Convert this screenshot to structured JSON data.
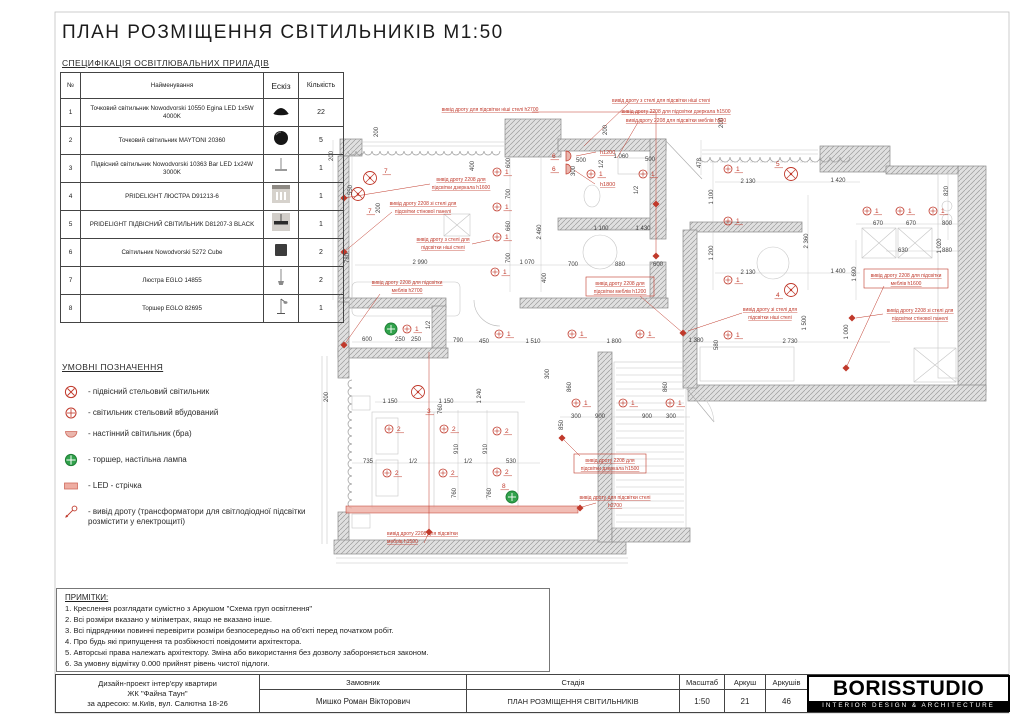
{
  "title": "ПЛАН РОЗМІЩЕННЯ СВІТИЛЬНИКІВ М1:50",
  "spec": {
    "heading": "СПЕЦИФІКАЦІЯ ОСВІТЛЮВАЛЬНИХ ПРИЛАДІВ",
    "headers": [
      "№",
      "Найменування",
      "Ескіз",
      "Кількість"
    ],
    "rows": [
      {
        "num": "1",
        "name": "Точковий світильник Nowodvorski 10550 Egina LED 1x5W 4000K",
        "sketch": "spot-black",
        "qty": "22"
      },
      {
        "num": "2",
        "name": "Точковий світильник MAYTONI 20360",
        "sketch": "spot-round",
        "qty": "5"
      },
      {
        "num": "3",
        "name": "Підвісний світильник Nowodvorski 10363 Bar LED 1x24W 3000K",
        "sketch": "bar-pendant",
        "qty": "1"
      },
      {
        "num": "4",
        "name": "PRIDELIGHT ЛЮСТРА D91213-6",
        "sketch": "chandelier",
        "qty": "1"
      },
      {
        "num": "5",
        "name": "PRIDELIGHT ПІДВІСНИЙ СВІТИЛЬНИК D81207-3 BLACK",
        "sketch": "pendant-black",
        "qty": "1"
      },
      {
        "num": "6",
        "name": "Світильник Nowodvorski 5272 Cube",
        "sketch": "cube",
        "qty": "2"
      },
      {
        "num": "7",
        "name": "Люстра EGLO 14855",
        "sketch": "hanging",
        "qty": "2"
      },
      {
        "num": "8",
        "name": "Торшер EGLO 82695",
        "sketch": "floor-lamp",
        "qty": "1"
      }
    ]
  },
  "legend": {
    "heading": "УМОВНІ ПОЗНАЧЕННЯ",
    "items": [
      {
        "icon": "pendant-icon",
        "label": "- підвісний стельовий світильник"
      },
      {
        "icon": "recessed-icon",
        "label": "- світильник стельовий вбудований"
      },
      {
        "icon": "bra-icon",
        "label": "- настінний світильник (бра)"
      },
      {
        "icon": "torcher-icon",
        "label": "- торшер, настільна лампа"
      },
      {
        "icon": "led-icon",
        "label": "- LED - стрічка"
      },
      {
        "icon": "wire-icon",
        "label": "- вивід дроту (трансформатори для світлодіодної підсвітки розмістити у електрощиті)"
      }
    ]
  },
  "notes": {
    "heading": "ПРИМІТКИ:",
    "lines": [
      "1. Креслення розглядати сумістно з Аркушом \"Схема груп освітлення\"",
      "2. Всі розміри вказано у міліметрах, якщо не вказано інше.",
      "3. Всі підрядники повинні перевірити розміри безпосередньо на об'єкті перед початком робіт.",
      "4. Про будь які припущення та розбіжності повідомити архітектора.",
      "5. Авторські права належать архітектору. Зміна або використання без дозволу забороняється законом.",
      "6. За умовну відмітку 0.000 прийнят рівень чистої підлоги."
    ]
  },
  "titleblock": {
    "project_lines": [
      "Дизайн-проект інтер'єру квартири",
      "ЖК \"Файна Таун\"",
      "за адресою: м.Київ, вул. Салютна 18-26"
    ],
    "customer_label": "Замовник",
    "customer_value": "Мишко Роман Вікторович",
    "stage_label": "Стадія",
    "stage_value": "ПЛАН РОЗМІЩЕННЯ СВІТИЛЬНИКІВ",
    "scale_label": "Масштаб",
    "scale_value": "1:50",
    "sheet_label": "Аркуш",
    "sheet_value": "21",
    "sheets_label": "Аркушів",
    "sheets_value": "46",
    "logo_name": "BORISSTUDIO",
    "logo_sub": "INTERIOR DESIGN & ARCHITECTURE"
  },
  "colors": {
    "annotation_red": "#c0392b",
    "led_fill": "#eeada2",
    "torcher_green": "#31a24c",
    "dim_gray": "#3f3f3f",
    "wall_gray": "#dddddd"
  },
  "plan": {
    "h_labels": [
      {
        "t": "h1200",
        "x": 600,
        "y": 154
      },
      {
        "t": "h1800",
        "x": 600,
        "y": 186
      }
    ],
    "annotations": [
      {
        "l": [
          "вивід дроту для підсвітки ніші стелі h2700"
        ],
        "x": 490,
        "y": 111,
        "a": "middle"
      },
      {
        "l": [
          "вивід дроту з стелі для підсвітки ніші стелі"
        ],
        "x": 661,
        "y": 102,
        "a": "middle"
      },
      {
        "l": [
          "вивід дроту 2208 для підсвітки дзеркала h1500"
        ],
        "x": 676,
        "y": 113,
        "a": "middle"
      },
      {
        "l": [
          "вивід дроту 2208 для підсвітки меблів h500"
        ],
        "x": 676,
        "y": 122,
        "a": "middle"
      },
      {
        "l": [
          "вивід дроту 2208 для",
          "підсвітки дзеркала h1600"
        ],
        "x": 461,
        "y": 181,
        "a": "middle"
      },
      {
        "l": [
          "вивід дроту 2208 зі стелі для",
          "підсвітки стінової панелі"
        ],
        "x": 423,
        "y": 205,
        "a": "middle"
      },
      {
        "l": [
          "вивід дроту з стелі для",
          "підсвітки ніші стелі"
        ],
        "x": 443,
        "y": 241,
        "a": "middle"
      },
      {
        "l": [
          "вивід дроту 2208 для підсвітки",
          "меблів h2700"
        ],
        "x": 407,
        "y": 284,
        "a": "middle"
      },
      {
        "l": [
          "вивід дроту 2208 для",
          "підсвітки меблів h1200"
        ],
        "x": 620,
        "y": 285,
        "a": "middle",
        "box": [
          586,
          277,
          68,
          19
        ]
      },
      {
        "l": [
          "вивід дроту 2208 для підсвітки",
          "меблів h1600"
        ],
        "x": 906,
        "y": 277,
        "a": "middle",
        "box": [
          864,
          269,
          84,
          19
        ]
      },
      {
        "l": [
          "вивід дроту зі стелі для",
          "підсвітки ніші стелі"
        ],
        "x": 770,
        "y": 311,
        "a": "middle"
      },
      {
        "l": [
          "вивід дроту 2208 зі стелі для",
          "підсвітки стінової панелі"
        ],
        "x": 920,
        "y": 312,
        "a": "middle"
      },
      {
        "l": [
          "вивід дроту 2208 для",
          "підсвітки дзеркала h1500"
        ],
        "x": 610,
        "y": 462,
        "a": "middle",
        "box": [
          574,
          454,
          72,
          19
        ]
      },
      {
        "l": [
          "вивід дроту для підсвітки стелі",
          "h2700"
        ],
        "x": 615,
        "y": 499,
        "a": "middle"
      },
      {
        "l": [
          "вивід дроту 2208 для підсвітки",
          "меблів h1500"
        ],
        "x": 387,
        "y": 535,
        "a": "start"
      }
    ],
    "dimensions": [
      [
        "200",
        333,
        156,
        1
      ],
      [
        "200",
        378,
        132,
        1
      ],
      [
        "550",
        352,
        190,
        1
      ],
      [
        "200",
        380,
        208,
        1
      ],
      [
        "780",
        349,
        258,
        1
      ],
      [
        "2 990",
        420,
        264,
        0
      ],
      [
        "1 070",
        527,
        264,
        0
      ],
      [
        "400",
        474,
        166,
        1
      ],
      [
        "600",
        510,
        163,
        1
      ],
      [
        "700",
        510,
        194,
        1
      ],
      [
        "660",
        510,
        226,
        1
      ],
      [
        "700",
        510,
        258,
        1
      ],
      [
        "2 460",
        541,
        232,
        1
      ],
      [
        "200",
        607,
        130,
        1
      ],
      [
        "500",
        581,
        162,
        0
      ],
      [
        "1 060",
        621,
        158,
        0
      ],
      [
        "500",
        650,
        161,
        0
      ],
      [
        "1/2",
        603,
        164,
        1
      ],
      [
        "1/2",
        638,
        190,
        1
      ],
      [
        "300",
        575,
        171,
        1
      ],
      [
        "478",
        701,
        163,
        1
      ],
      [
        "200",
        723,
        123,
        1
      ],
      [
        "2 130",
        748,
        183,
        0
      ],
      [
        "1 420",
        838,
        182,
        0
      ],
      [
        "1 100",
        713,
        197,
        1
      ],
      [
        "1 200",
        713,
        253,
        1
      ],
      [
        "2 360",
        808,
        241,
        1
      ],
      [
        "2 130",
        748,
        274,
        0
      ],
      [
        "1 400",
        838,
        273,
        0
      ],
      [
        "1 690",
        856,
        274,
        1
      ],
      [
        "820",
        948,
        191,
        1
      ],
      [
        "670",
        878,
        225,
        0
      ],
      [
        "670",
        911,
        225,
        0
      ],
      [
        "800",
        947,
        225,
        0
      ],
      [
        "1 020",
        941,
        246,
        1
      ],
      [
        "630",
        903,
        252,
        0
      ],
      [
        "880",
        947,
        252,
        0
      ],
      [
        "1 100",
        601,
        230,
        0
      ],
      [
        "1 430",
        643,
        230,
        0
      ],
      [
        "700",
        573,
        266,
        0
      ],
      [
        "880",
        620,
        266,
        0
      ],
      [
        "600",
        658,
        266,
        0
      ],
      [
        "600",
        367,
        341,
        0
      ],
      [
        "250",
        400,
        341,
        0
      ],
      [
        "250",
        416,
        341,
        0
      ],
      [
        "1/2",
        430,
        325,
        1
      ],
      [
        "790",
        458,
        342,
        0
      ],
      [
        "450",
        484,
        343,
        0
      ],
      [
        "1 510",
        533,
        343,
        0
      ],
      [
        "1 800",
        614,
        343,
        0
      ],
      [
        "1 380",
        696,
        342,
        0
      ],
      [
        "580",
        718,
        345,
        1
      ],
      [
        "2 730",
        790,
        343,
        0
      ],
      [
        "1 500",
        806,
        323,
        1
      ],
      [
        "1 000",
        848,
        332,
        1
      ],
      [
        "200",
        328,
        397,
        1
      ],
      [
        "1 150",
        390,
        403,
        0
      ],
      [
        "1 150",
        446,
        403,
        0
      ],
      [
        "1 240",
        481,
        396,
        1
      ],
      [
        "760",
        442,
        409,
        1
      ],
      [
        "910",
        458,
        449,
        1
      ],
      [
        "910",
        487,
        449,
        1
      ],
      [
        "760",
        456,
        493,
        1
      ],
      [
        "760",
        491,
        493,
        1
      ],
      [
        "735",
        368,
        463,
        0
      ],
      [
        "1/2",
        413,
        463,
        0
      ],
      [
        "1/2",
        468,
        463,
        0
      ],
      [
        "530",
        511,
        463,
        0
      ],
      [
        "400",
        546,
        278,
        1
      ],
      [
        "300",
        549,
        374,
        1
      ],
      [
        "860",
        571,
        387,
        1
      ],
      [
        "860",
        667,
        387,
        1
      ],
      [
        "300",
        576,
        418,
        0
      ],
      [
        "900",
        600,
        418,
        0
      ],
      [
        "900",
        647,
        418,
        0
      ],
      [
        "300",
        671,
        418,
        0
      ],
      [
        "850",
        563,
        425,
        1
      ]
    ],
    "pendants": [
      [
        370,
        178,
        "7",
        384,
        173
      ],
      [
        358,
        194,
        "7",
        368,
        213
      ],
      [
        791,
        174,
        "5",
        776,
        166
      ],
      [
        791,
        290,
        "4",
        776,
        297
      ],
      [
        418,
        392,
        "3",
        427,
        413
      ]
    ],
    "spots": [
      [
        497,
        172,
        "1"
      ],
      [
        497,
        207,
        "1"
      ],
      [
        497,
        237,
        "1"
      ],
      [
        495,
        272,
        "1"
      ],
      [
        591,
        174,
        "1"
      ],
      [
        643,
        174,
        "1"
      ],
      [
        728,
        169,
        "1"
      ],
      [
        728,
        221,
        "1"
      ],
      [
        728,
        280,
        "1"
      ],
      [
        728,
        335,
        "1"
      ],
      [
        867,
        211,
        "1"
      ],
      [
        900,
        211,
        "1"
      ],
      [
        933,
        211,
        "1"
      ],
      [
        499,
        334,
        "1"
      ],
      [
        572,
        334,
        "1"
      ],
      [
        640,
        334,
        "1"
      ],
      [
        576,
        403,
        "1"
      ],
      [
        623,
        403,
        "1"
      ],
      [
        670,
        403,
        "1"
      ],
      [
        407,
        329,
        "1"
      ],
      [
        389,
        429,
        "2"
      ],
      [
        444,
        429,
        "2"
      ],
      [
        497,
        431,
        "2"
      ],
      [
        387,
        473,
        "2"
      ],
      [
        443,
        473,
        "2"
      ],
      [
        497,
        472,
        "2"
      ]
    ],
    "bras": [
      [
        566,
        156,
        "6"
      ],
      [
        566,
        169,
        "6"
      ]
    ],
    "torchers": [
      [
        391,
        329,
        "",
        0,
        0
      ],
      [
        512,
        497,
        "8",
        502,
        488
      ]
    ],
    "led_strips": [
      [
        346,
        506,
        232,
        7
      ]
    ],
    "markers": [
      [
        656,
        204
      ],
      [
        656,
        256
      ],
      [
        344,
        198
      ],
      [
        344,
        252
      ],
      [
        344,
        345
      ],
      [
        683,
        333
      ],
      [
        846,
        368
      ],
      [
        852,
        318
      ],
      [
        562,
        438
      ],
      [
        580,
        508
      ],
      [
        429,
        532
      ]
    ]
  }
}
